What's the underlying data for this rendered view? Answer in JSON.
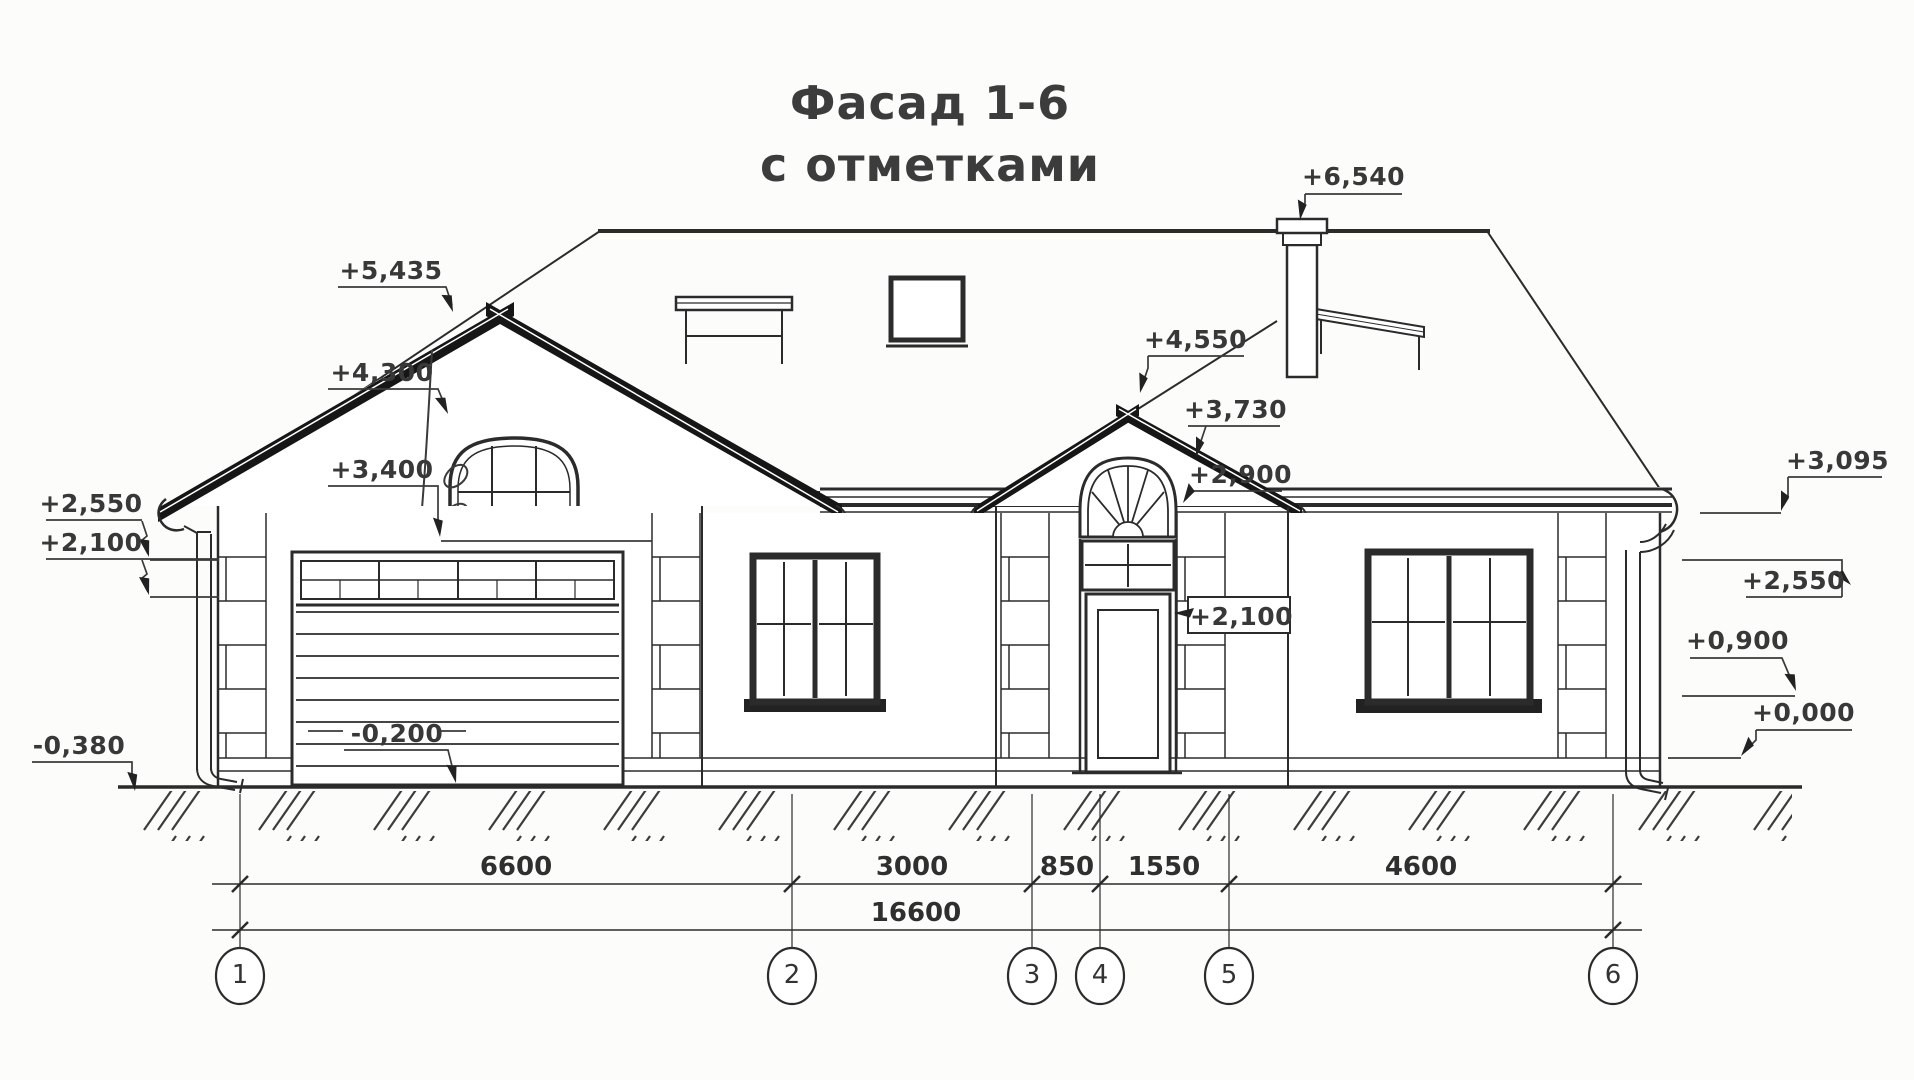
{
  "title": {
    "line1": "Фасад 1-6",
    "line2": "с отметками"
  },
  "marks": {
    "m5435": "+5,435",
    "m4300": "+4,300",
    "m3400": "+3,400",
    "m2550_left": "+2,550",
    "m2100_left": "+2,100",
    "m0380": "-0,380",
    "m0200": "-0,200",
    "m4550": "+4,550",
    "m3730": "+3,730",
    "m2900": "+2,900",
    "m2100_center": "+2,100",
    "m6540": "+6,540",
    "m3095": "+3,095",
    "m2550_right": "+2,550",
    "m0900": "+0,900",
    "m0000": "+0,000"
  },
  "dimensions": {
    "seg_1_2": "6600",
    "seg_2_3": "3000",
    "seg_3_4": "850",
    "seg_4_5": "1550",
    "seg_5_6": "4600",
    "total": "16600"
  },
  "axes": {
    "a1": "1",
    "a2": "2",
    "a3": "3",
    "a4": "4",
    "a5": "5",
    "a6": "6"
  },
  "colors": {
    "ink": "#2b2b2b",
    "paper": "#fcfcfa",
    "roof_texture": "#ccccc8",
    "title_text": "#3c3c3c"
  }
}
